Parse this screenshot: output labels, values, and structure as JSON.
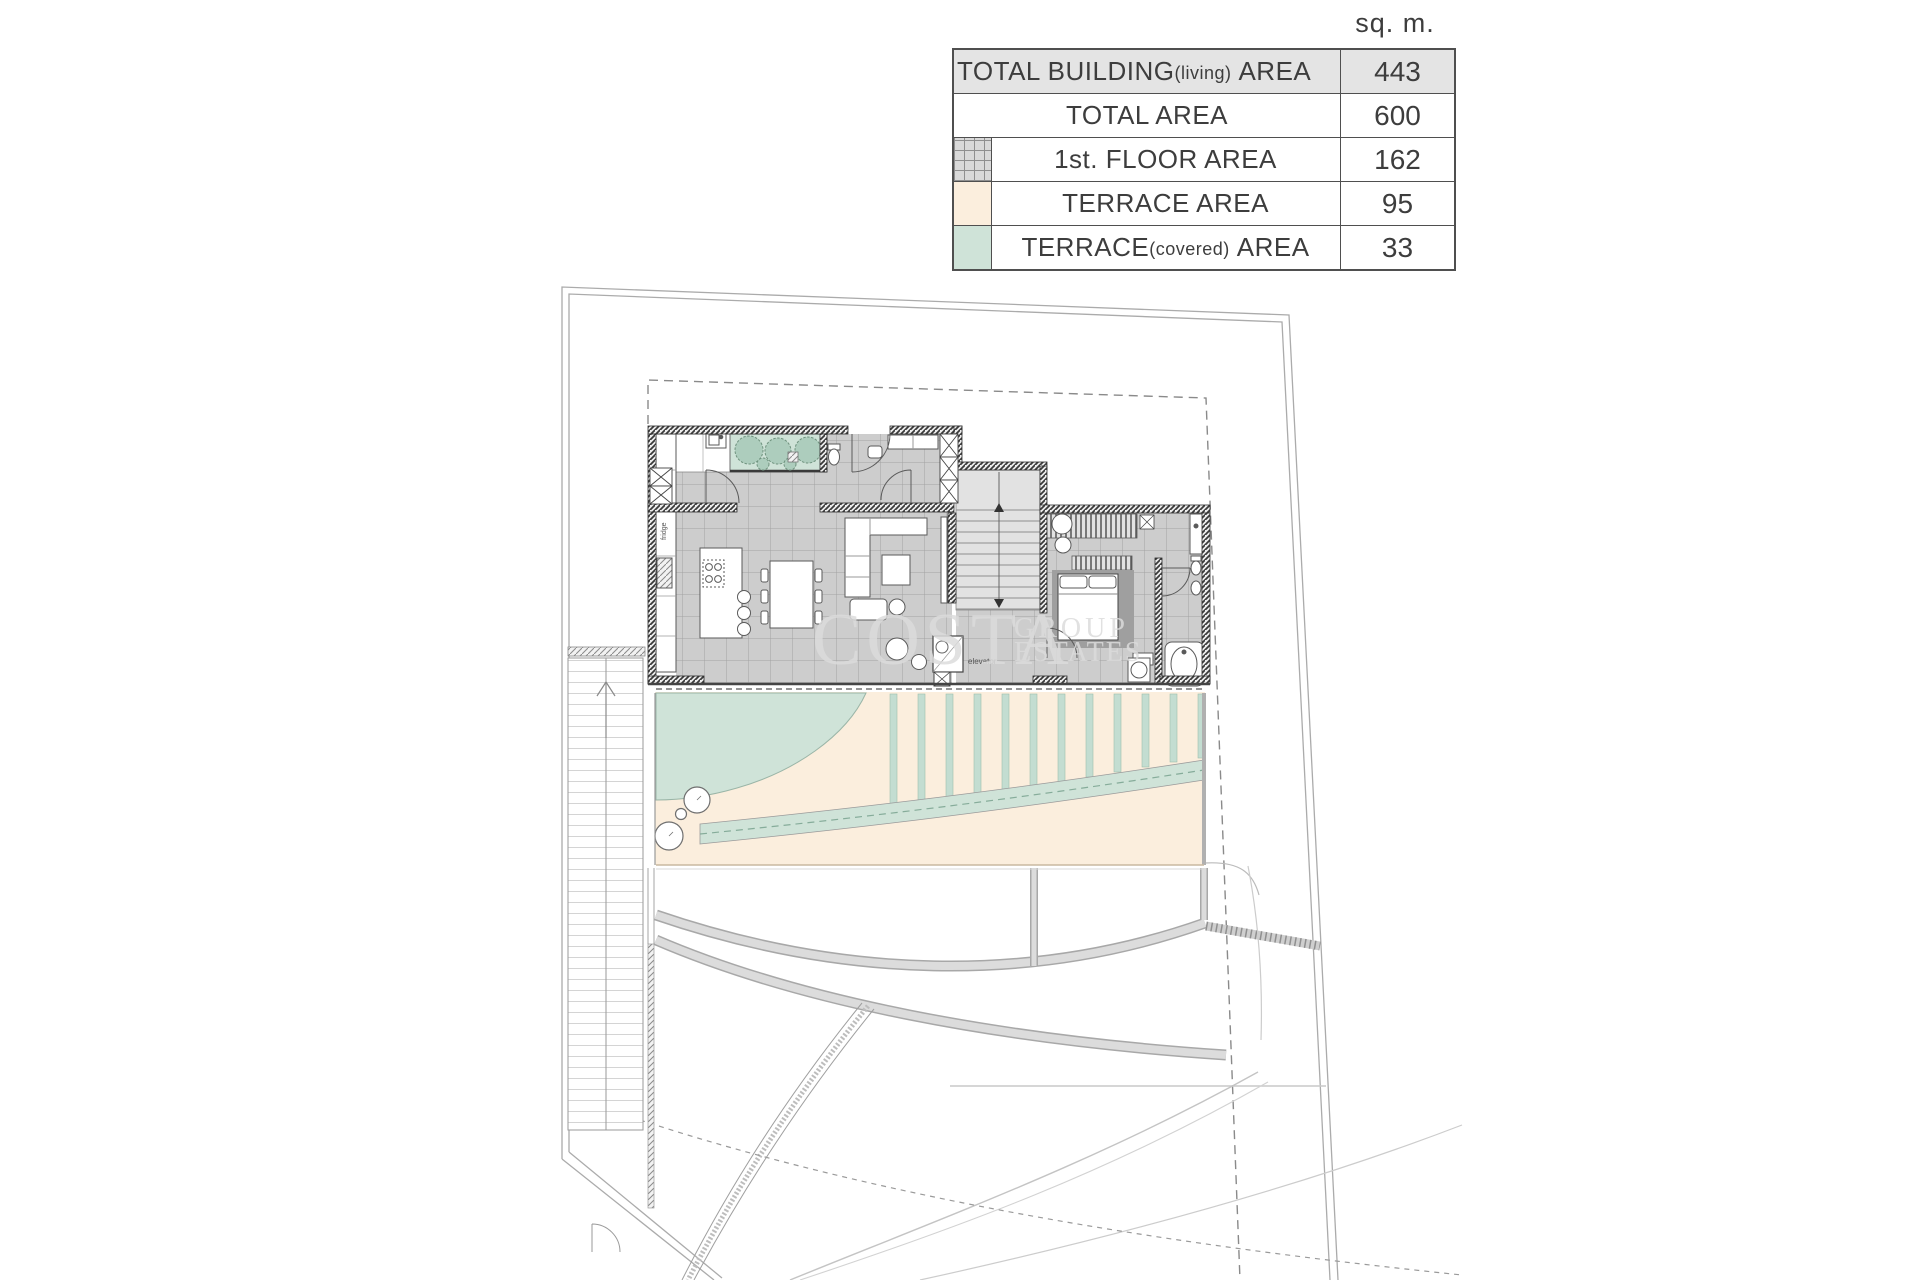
{
  "units_header": "sq. m.",
  "table": {
    "rows": [
      {
        "main": "TOTAL BUILDING",
        "sub": "(living)",
        "tail": "AREA",
        "value": "443"
      },
      {
        "main": "TOTAL AREA",
        "sub": "",
        "tail": "",
        "value": "600"
      },
      {
        "main": "1st. FLOOR AREA",
        "sub": "",
        "tail": "",
        "value": "162"
      },
      {
        "main": "TERRACE AREA",
        "sub": "",
        "tail": "",
        "value": "95"
      },
      {
        "main": "TERRACE",
        "sub": "(covered)",
        "tail": "AREA",
        "value": "33"
      }
    ]
  },
  "watermark": {
    "line1": "COSTA",
    "line2": "GROUP",
    "line3": "ESTATES"
  },
  "plan_labels": {
    "elevator": "elevator",
    "fridge": "fridge"
  },
  "colors": {
    "terrace_area": "#fbeedd",
    "terrace_covered": "#cfe3d8",
    "floor_tiles": "#cdcdcd",
    "row_highlight": "#e4e4e4",
    "wall_dark": "#3a3a3a",
    "boundary_line": "#ababab"
  }
}
